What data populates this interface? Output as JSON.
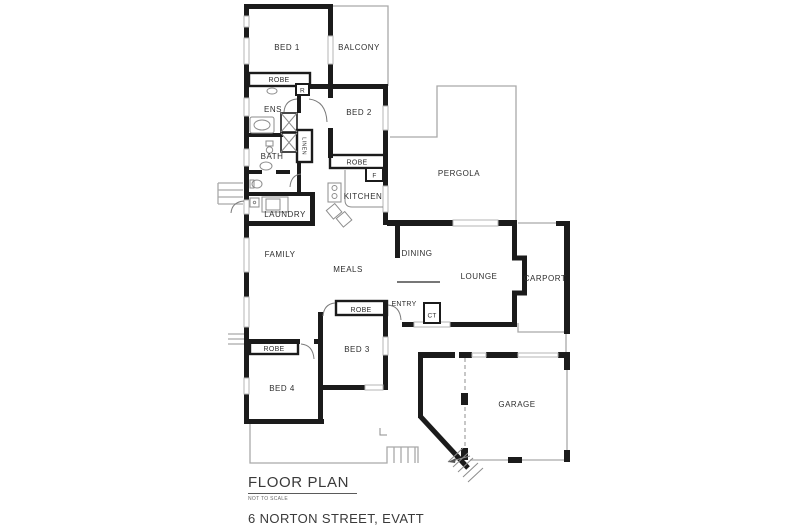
{
  "footer": {
    "title": "FLOOR PLAN",
    "note": "NOT TO SCALE",
    "address": "6 NORTON STREET, EVATT"
  },
  "rooms": {
    "bed1": "BED 1",
    "balcony": "BALCONY",
    "robe_bed1": "ROBE",
    "recess": "R",
    "ens": "ENS",
    "bed2": "BED 2",
    "bath": "BATH",
    "linen": "LINEN",
    "robe_bed2": "ROBE",
    "fridge": "F",
    "pergola": "PERGOLA",
    "kitchen": "KITCHEN",
    "laundry": "LAUNDRY",
    "family": "FAMILY",
    "meals": "MEALS",
    "dining": "DINING",
    "lounge": "LOUNGE",
    "carport": "CARPORT",
    "entry": "ENTRY",
    "ct": "CT",
    "robe_bed3": "ROBE",
    "bed3": "BED 3",
    "robe_bed4": "ROBE",
    "bed4": "BED 4",
    "garage": "GARAGE"
  },
  "colors": {
    "wall": "#1b1b1b",
    "thin_line": "#a9a9a9",
    "window": "#ffffff",
    "label": "#2e2e2e",
    "background": "#ffffff"
  }
}
